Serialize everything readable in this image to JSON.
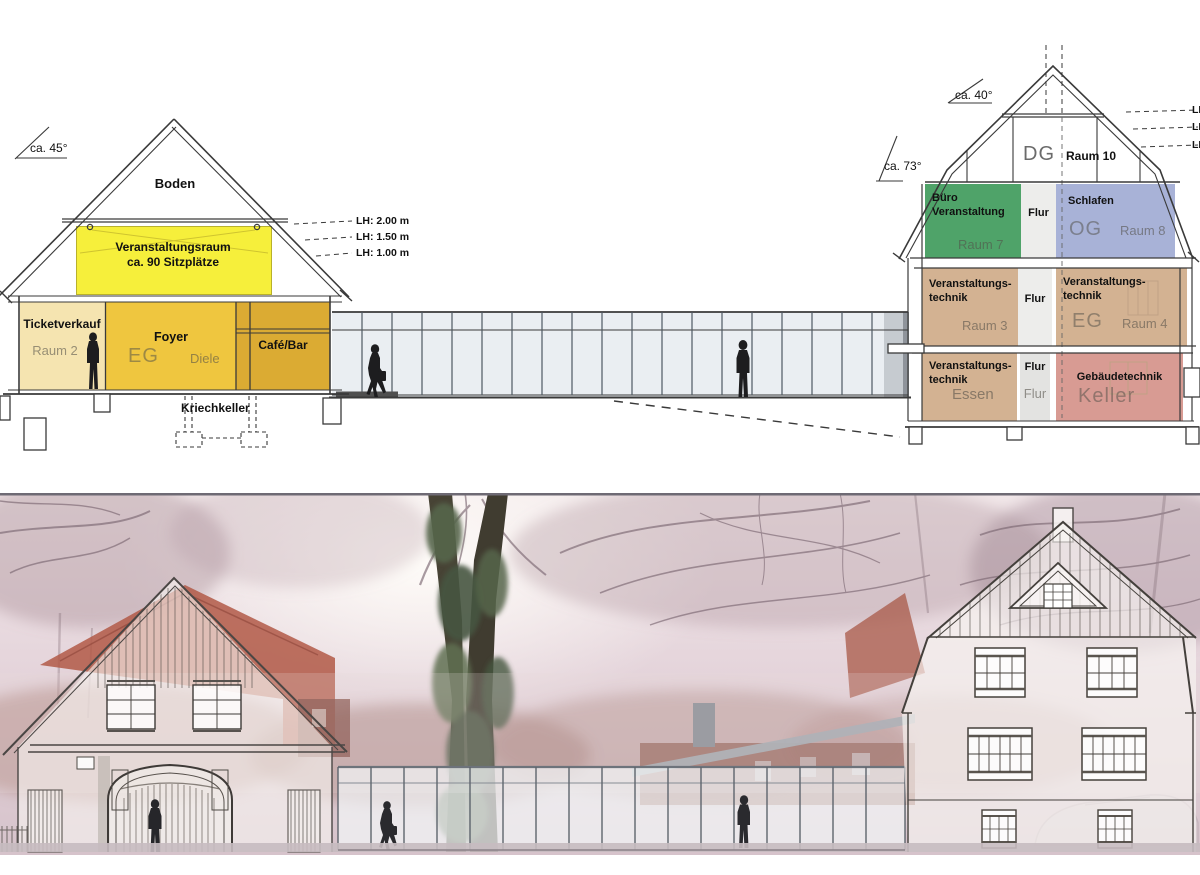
{
  "drawing": {
    "left_building": {
      "roof_angle": "ca. 45°",
      "attic": "Boden",
      "hall": {
        "line1": "Veranstaltungsraum",
        "line2": "ca. 90 Sitzplätze",
        "color": "#f6ef3b"
      },
      "height_labels": [
        "LH:  2.00 m",
        "LH:  1.50 m",
        "LH:  1.00 m"
      ],
      "rooms": {
        "ticket": {
          "name": "Ticketverkauf",
          "ghost": "Raum 2",
          "color": "#f5e4b0"
        },
        "foyer": {
          "name": "Foyer",
          "ghost_big": "EG",
          "ghost": "Diele",
          "color": "#efc63f"
        },
        "cafe": {
          "name": "Café/Bar",
          "color": "#dbab33"
        }
      },
      "basement": "Kriechkeller"
    },
    "right_building": {
      "upper_roof_angle": "ca. 40°",
      "lower_roof_angle": "ca. 73°",
      "attic": {
        "ghost_big": "DG",
        "name": "Raum 10"
      },
      "height_labels_clipped": [
        "LH",
        "LH",
        "LH"
      ],
      "floors": {
        "og": {
          "left": {
            "name1": "Büro",
            "name2": "Veranstaltung",
            "ghost": "Raum 7",
            "color": "#4fa369"
          },
          "mid": {
            "name": "Flur",
            "color": "#ededeb"
          },
          "right": {
            "name": "Schlafen",
            "ghost_big": "OG",
            "ghost": "Raum 8",
            "color": "#a8b2d7"
          }
        },
        "eg": {
          "left": {
            "name1": "Veranstaltungs-",
            "name2": "technik",
            "ghost": "Raum 3",
            "color": "#d3b292"
          },
          "mid": {
            "name": "Flur",
            "color": "#ededeb"
          },
          "right": {
            "name1": "Veranstaltungs-",
            "name2": "technik",
            "ghost_big": "EG",
            "ghost": "Raum 4",
            "color": "#d3b292"
          }
        },
        "kg": {
          "left": {
            "name1": "Veranstaltungs-",
            "name2": "technik",
            "ghost": "Essen",
            "color": "#d3b292"
          },
          "mid": {
            "name": "Flur",
            "ghost": "Flur",
            "color": "#e3e3e1"
          },
          "right": {
            "name": "Gebäudetechnik",
            "ghost_big": "Keller",
            "color": "#d89b93"
          }
        }
      }
    },
    "corridor": {
      "glass_color": "#eaeef2",
      "mullion_color": "#4e5862"
    }
  }
}
